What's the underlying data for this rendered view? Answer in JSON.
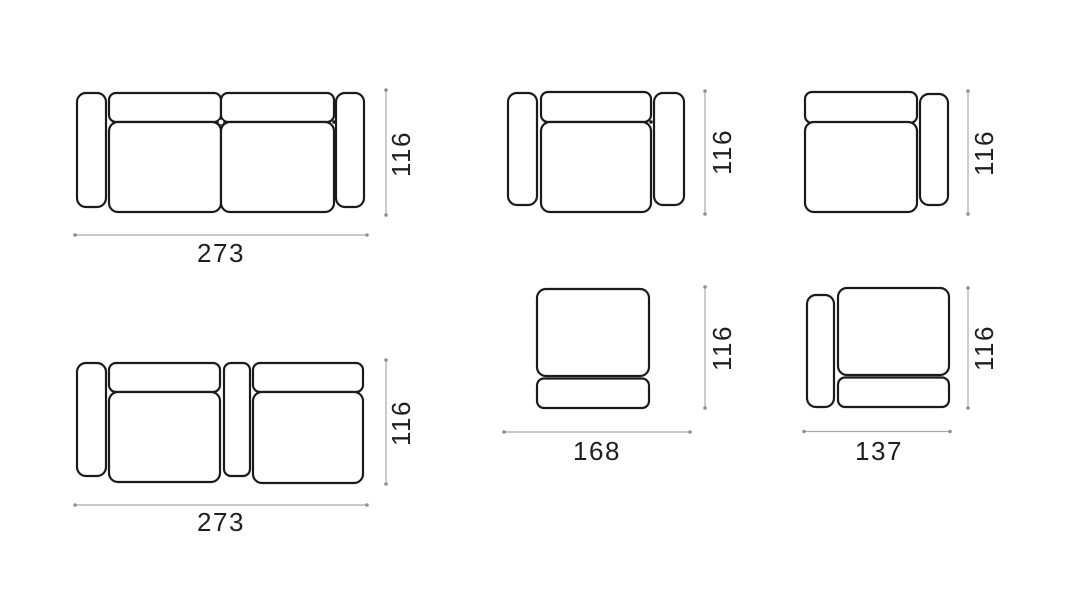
{
  "style": {
    "background": "#ffffff",
    "outline_color": "#1b1b1b",
    "dimension_line_color": "#a9a9a9",
    "label_color": "#1f1f1f"
  },
  "diagrams": [
    {
      "name": "two-arm sofa plan view",
      "width_label": "273",
      "height_label": "116"
    },
    {
      "name": "armchair plan view",
      "height_label": "116"
    },
    {
      "name": "module with right arm plan view",
      "height_label": "116"
    },
    {
      "name": "sofa with left arm and center connector plan view",
      "width_label": "273",
      "height_label": "116"
    },
    {
      "name": "armless module plan view",
      "width_label": "168",
      "height_label": "116"
    },
    {
      "name": "module with left arm plan view",
      "width_label": "137",
      "height_label": "116"
    }
  ]
}
